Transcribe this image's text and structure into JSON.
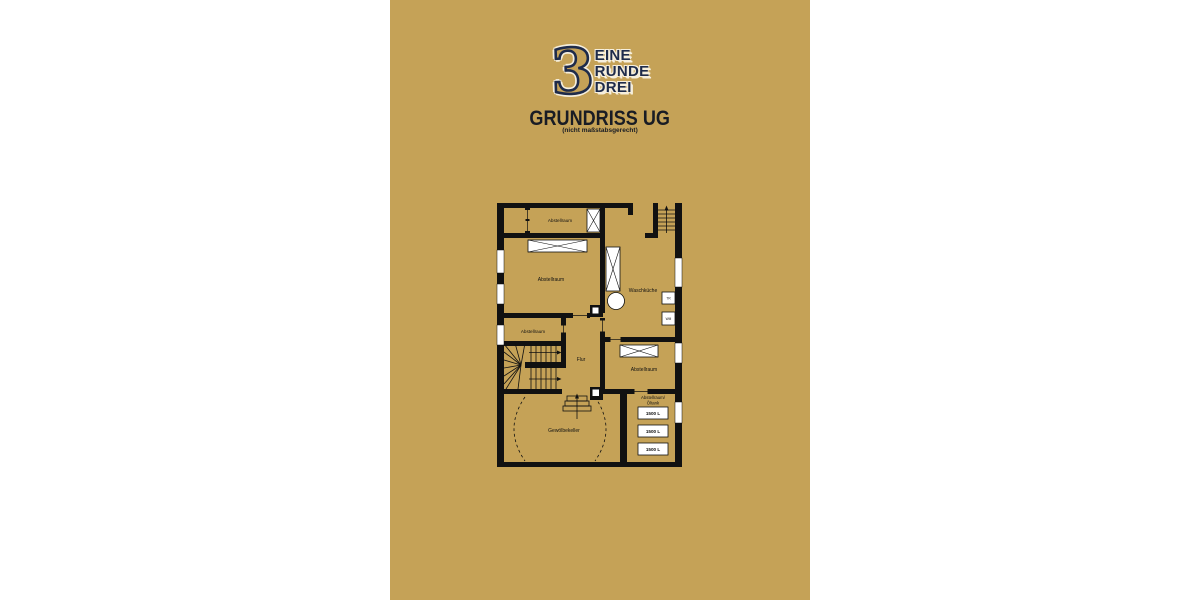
{
  "colors": {
    "page_background": "#ffffff",
    "panel_gold": "#c5a257",
    "logo_navy": "#1e2b4a",
    "logo_outline_cream": "#f6efdd",
    "wall_black": "#111111",
    "fixture_white": "#ffffff"
  },
  "logo": {
    "numeral": "3",
    "lines": [
      "EINE",
      "RUNDE",
      "DREI"
    ]
  },
  "header": {
    "title": "GRUNDRISS UG",
    "subtitle": "(nicht maßstabsgerecht)"
  },
  "floorplan": {
    "labels": {
      "storage_top": "Abstellraum",
      "storage_large": "Abstellraum",
      "storage_mid": "Abstellraum",
      "hall": "Flur",
      "laundry": "Waschküche",
      "storage_right": "Abstellraum",
      "tankroom_line1": "Abstellraum/",
      "tankroom_line2": "Öltank",
      "cellar": "Gewölbekeller",
      "tank_1": "1500 L",
      "tank_2": "1500 L",
      "tank_3": "1500 L",
      "dryer": "TR",
      "washer": "WM"
    }
  }
}
